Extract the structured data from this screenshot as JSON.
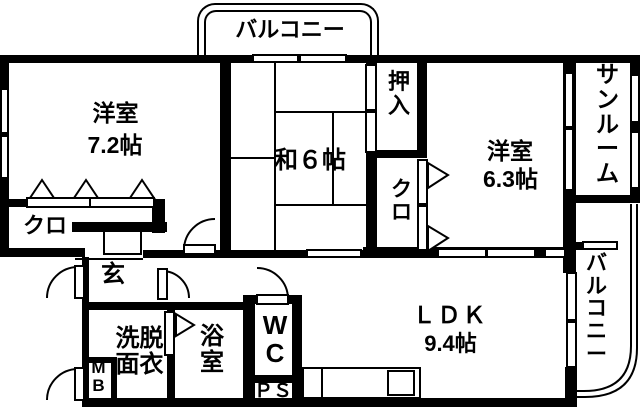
{
  "plan_title": "間取り図",
  "colors": {
    "line": "#000000",
    "background": "#ffffff"
  },
  "rooms": {
    "balcony_top": {
      "label": "バルコニー"
    },
    "western_room_1": {
      "name": "洋室",
      "size": "7.2帖"
    },
    "japanese_room": {
      "name": "和６帖"
    },
    "oshiire": {
      "label": "押入"
    },
    "closet_mid": {
      "label": "クロ"
    },
    "closet_left": {
      "label": "クロ"
    },
    "western_room_2": {
      "name": "洋室",
      "size": "6.3帖"
    },
    "sunroom": {
      "label": "サンルーム"
    },
    "balcony_right": {
      "label": "バルコニー"
    },
    "entrance": {
      "label": "玄"
    },
    "washroom": {
      "label": "洗脱面衣"
    },
    "bathroom": {
      "label": "浴室"
    },
    "wc": {
      "label": "WC"
    },
    "pipe_space": {
      "label": "ＰＳ"
    },
    "meter_box": {
      "label": "MB"
    },
    "ldk": {
      "name": "ＬＤＫ",
      "size": "9.4帖"
    }
  }
}
